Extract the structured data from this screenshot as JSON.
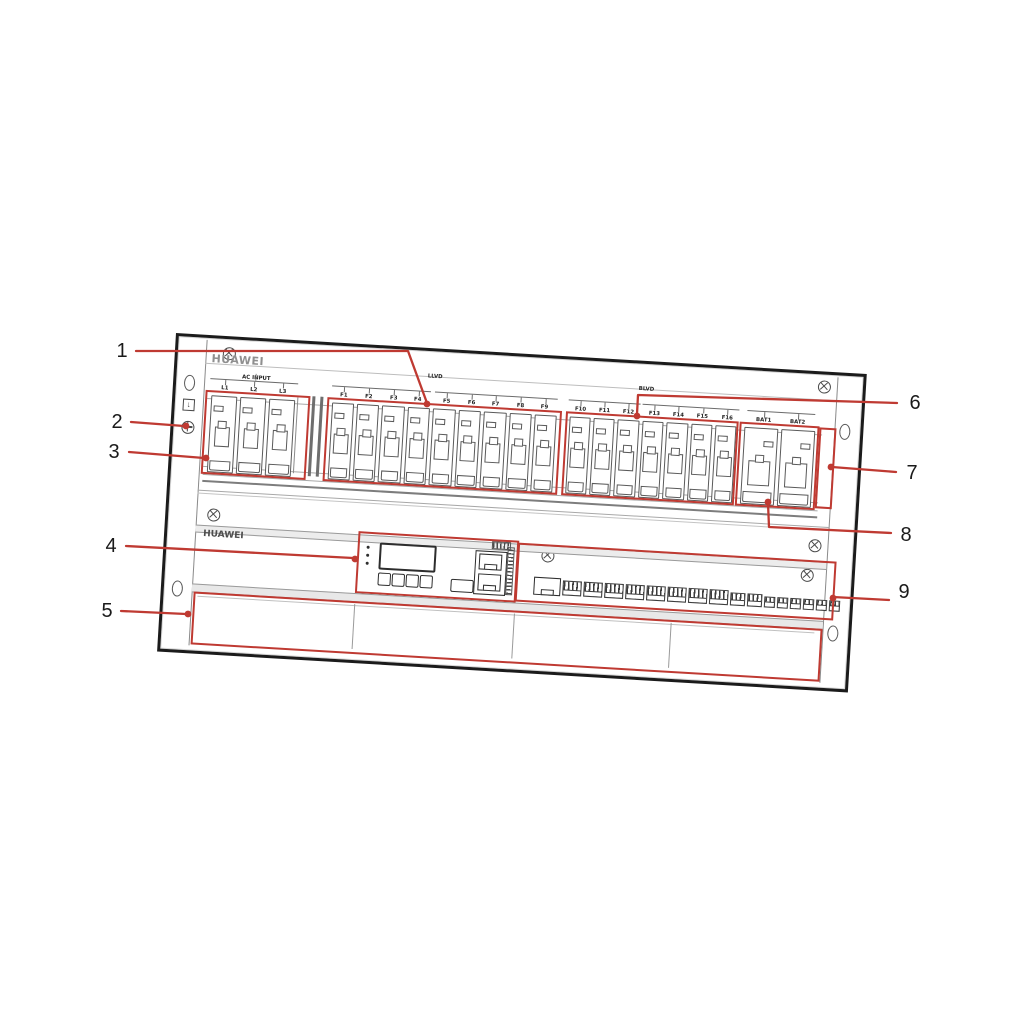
{
  "figure": {
    "callout_labels": [
      "1",
      "2",
      "3",
      "4",
      "5",
      "6",
      "7",
      "8",
      "9"
    ],
    "annotation_color": "#bf3a32"
  },
  "panel": {
    "brand_logo": "HUAWEI",
    "subrack_label": "HUAWEI",
    "sections": {
      "ac": {
        "title": "AC INPUT",
        "breakers": [
          "L1",
          "L2",
          "L3"
        ]
      },
      "llvd": {
        "title": "LLVD",
        "group1": [
          "F1",
          "F2",
          "F3",
          "F4"
        ],
        "group2": [
          "F5",
          "F6",
          "F7",
          "F8",
          "F9"
        ]
      },
      "blvd": {
        "title": "BLVD",
        "group1": [
          "F10",
          "F11",
          "F12"
        ],
        "group2": [
          "F13",
          "F14",
          "F15",
          "F16"
        ]
      },
      "battery": {
        "labels": [
          "BAT1",
          "BAT2"
        ]
      }
    }
  }
}
